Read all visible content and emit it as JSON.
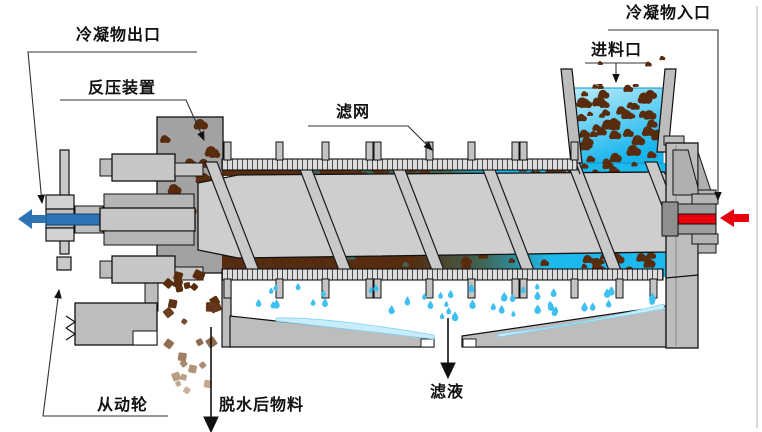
{
  "diagram": {
    "subject": "screw-press-dewatering-machine-schematic",
    "labels": {
      "condensate_outlet": "冷凝物出口",
      "back_pressure_device": "反压装置",
      "filter_screen": "滤网",
      "feed_inlet": "进料口",
      "condensate_inlet": "冷凝物入口",
      "driven_wheel": "从动轮",
      "dewatered_material": "脱水后物料",
      "filtrate": "滤液"
    },
    "flows": {
      "condensate_out_direction": "left",
      "condensate_in_direction": "left"
    },
    "colors": {
      "machine_gray": "#bdbdbd",
      "shaft_gray": "#cecece",
      "dark_housing_gray": "#a2a2a2",
      "slurry_light": "#b9ecfa",
      "slurry_cyan": "#17b4ee",
      "sludge_brown": "#552c10",
      "particle_brown": "#5a2c0e",
      "particle_faded": "#c8b29a",
      "teal_mix": "#3f6555",
      "droplet_blue": "#3fc0f0",
      "trough_liquid": "#c9ecfa",
      "condensate_out_blue": "#2e74b5",
      "condensate_in_red": "#e8000d",
      "leader_line": "#333333"
    }
  }
}
